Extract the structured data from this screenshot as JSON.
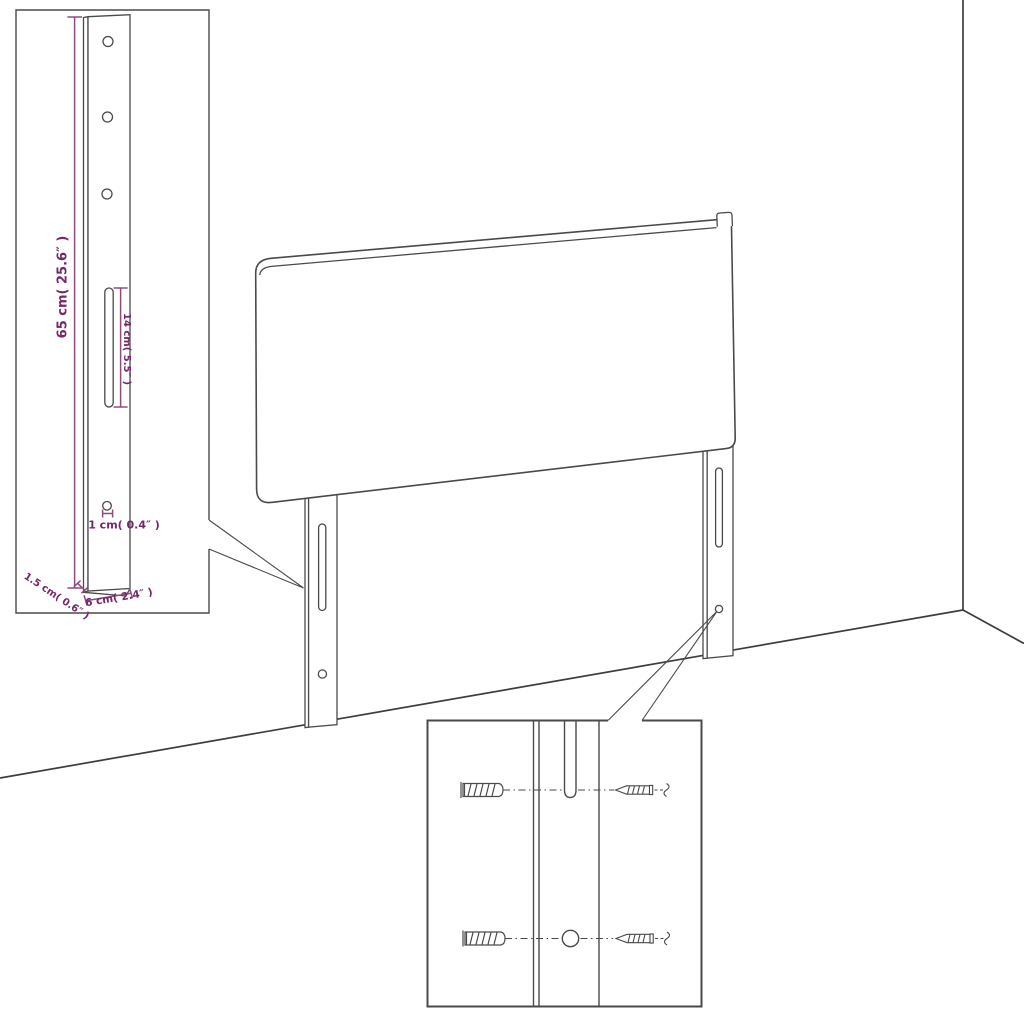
{
  "diagram": {
    "title": "headboard-dimension-diagram",
    "colors": {
      "line": "#4a4a4a",
      "room_line": "#3d3d3d",
      "dimension_line": "#8e4b80",
      "dimension_text": "#76276a",
      "background": "#ffffff"
    },
    "leg_detail": {
      "labels": {
        "height": "65 cm( 25.6″ )",
        "slot": "14 cm( 5.5″ )",
        "hole": "1 cm( 0.4″ )",
        "depth": "1.5 cm( 0.6″ )",
        "width": "6 cm( 2.4″ )"
      }
    },
    "mounting_detail": {
      "parts": [
        "wall-plug",
        "screw",
        "wall-plug",
        "screw"
      ]
    }
  }
}
